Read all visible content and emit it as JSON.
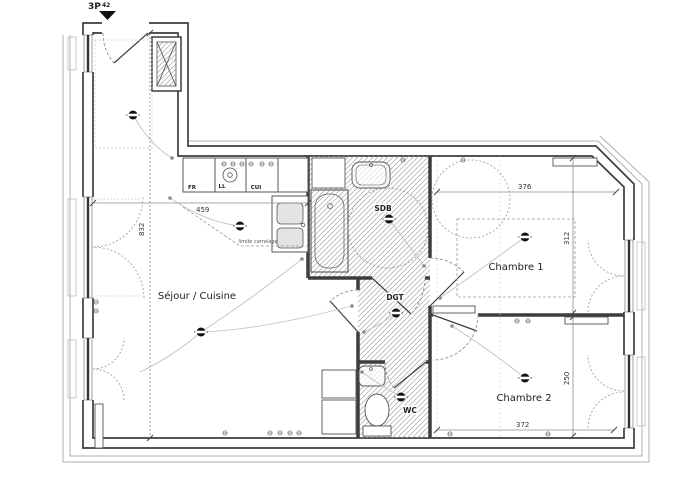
{
  "plan": {
    "entrance_marker": {
      "type_label": "3P",
      "area_label": "42"
    },
    "rooms": {
      "sejour": "Séjour / Cuisine",
      "chambre1": "Chambre 1",
      "chambre2": "Chambre 2",
      "sdb": "SDB",
      "dgt": "DGT",
      "wc": "WC"
    },
    "kitchen_units": {
      "fr": "FR",
      "ll": "LL",
      "cui": "CUI"
    },
    "dimensions": {
      "sejour_height": "832",
      "kitchen_width": "459",
      "chambre1_width": "376",
      "chambre1_height": "312",
      "chambre2_width": "372",
      "chambre2_height": "250"
    },
    "notes": {
      "tile_limit": "limite carrelage"
    },
    "colors": {
      "wall": "#3d3d3d",
      "hatch": "#a8a8a8",
      "dashes": "#8f8f8f",
      "wiring": "#c2c2c2"
    }
  }
}
